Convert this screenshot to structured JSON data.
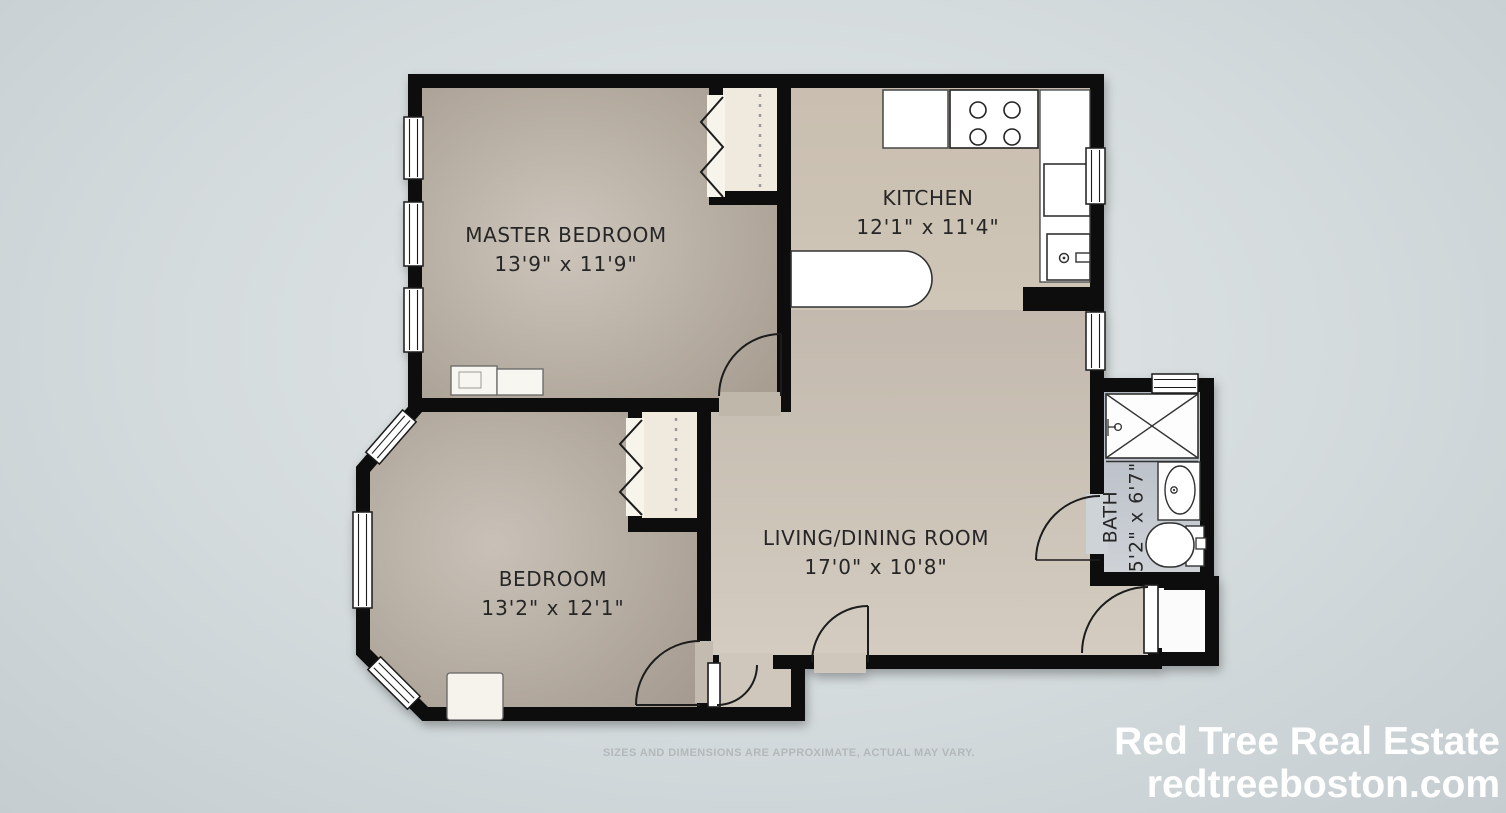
{
  "rooms": {
    "master_bedroom": {
      "name": "MASTER BEDROOM",
      "dimensions": "13'9\" x 11'9\""
    },
    "kitchen": {
      "name": "KITCHEN",
      "dimensions": "12'1\" x 11'4\""
    },
    "living_dining": {
      "name": "LIVING/DINING ROOM",
      "dimensions": "17'0\" x 10'8\""
    },
    "bedroom": {
      "name": "BEDROOM",
      "dimensions": "13'2\" x 12'1\""
    },
    "bath": {
      "name": "BATH",
      "dimensions": "5'2\" x 6'7\""
    }
  },
  "disclaimer": "SIZES AND DIMENSIONS ARE APPROXIMATE, ACTUAL MAY VARY.",
  "branding": {
    "company": "Red Tree Real Estate",
    "website": "redtreeboston.com"
  },
  "fixtures": [
    "stove",
    "kitchen-counter",
    "kitchen-sink",
    "dishwasher",
    "counter-peninsula",
    "shower",
    "bathroom-sink",
    "toilet",
    "closet-rod",
    "bench",
    "side-table"
  ],
  "colors": {
    "background": "#d4dbdd",
    "wall": "#0a0a0a",
    "floor_bedrooms": "#ab a19 6",
    "floor_living": "#ccc3b7",
    "bath_floor": "#bcc2ca",
    "label_text": "#262626",
    "disclaimer_text": "#b3b8ba",
    "branding_text": "#ffffff"
  }
}
